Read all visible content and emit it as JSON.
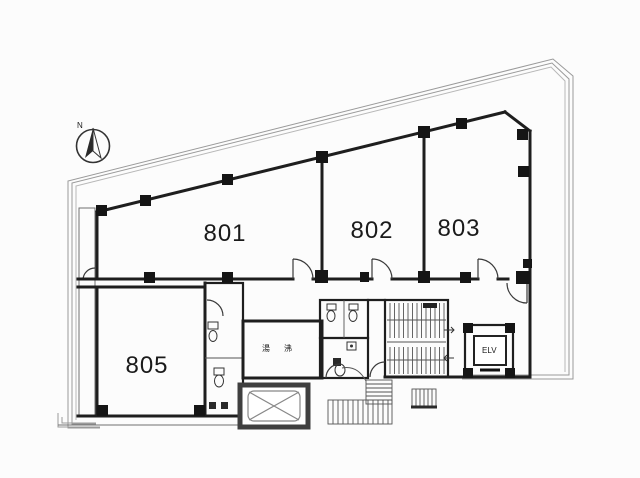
{
  "floor_plan": {
    "background": "#fcfcfc",
    "compass": {
      "label": "N"
    },
    "rooms": [
      {
        "number": "801"
      },
      {
        "number": "802"
      },
      {
        "number": "803"
      },
      {
        "number": "805"
      }
    ],
    "core": {
      "elevator_label": "ELV",
      "kitchenette_label": "湯沸"
    },
    "colors": {
      "wall": "#1e1e1e",
      "boundary": "#9a9a9a",
      "detail": "#555555",
      "text": "#1a1a1a"
    }
  }
}
